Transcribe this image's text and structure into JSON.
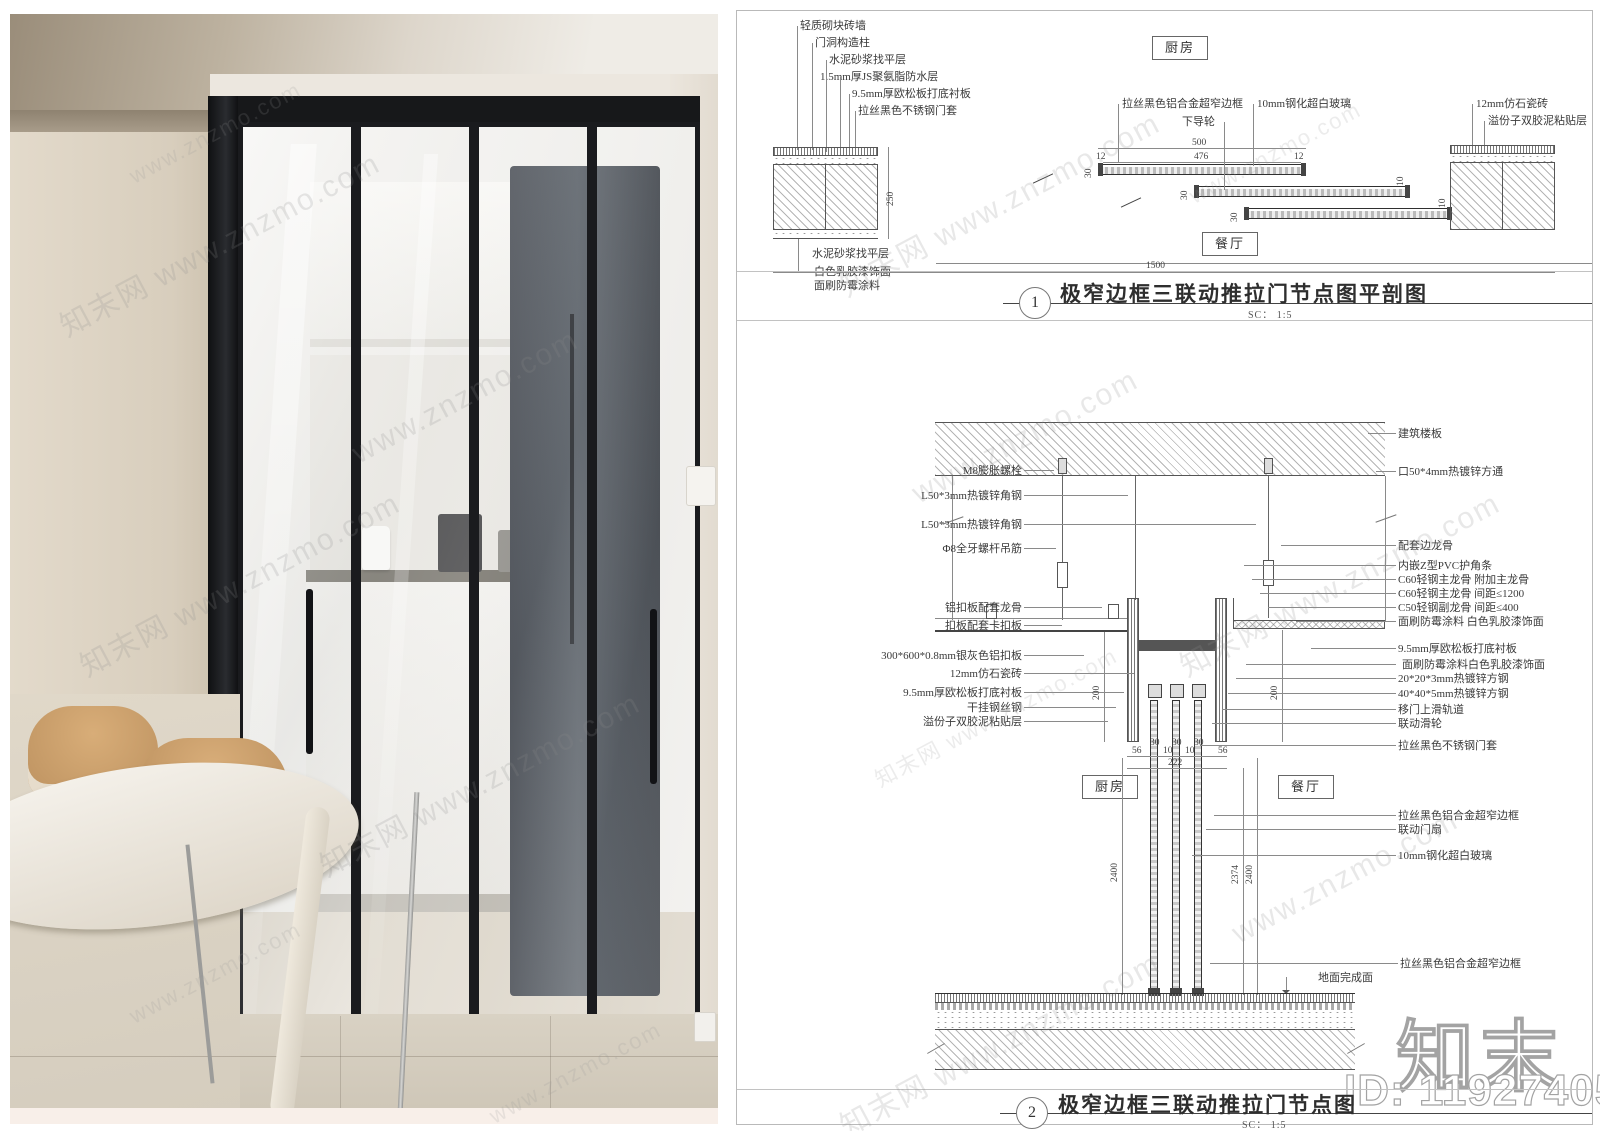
{
  "watermark": {
    "tile": "知末网 www.znzmo.com",
    "site": "www.znzmo.com"
  },
  "branding": {
    "logo": "知末",
    "id": "ID: 1192740511"
  },
  "drawing1": {
    "number": "1",
    "title": "极窄边框三联动推拉门节点图平剖图",
    "scale": "SC：  1:5",
    "room_top": "厨房",
    "room_bottom": "餐厅",
    "wall_labels_left": [
      "轻质砌块砖墙",
      "门洞构造柱",
      "水泥砂浆找平层",
      "1.5mm厚JS聚氨脂防水层",
      "9.5mm厚欧松板打底衬板",
      "拉丝黑色不锈钢门套"
    ],
    "door_labels": [
      "拉丝黑色铝合金超窄边框",
      "下导轮",
      "10mm钢化超白玻璃"
    ],
    "wall_labels_right": [
      "12mm仿石瓷砖",
      "溢份子双胶泥粘贴层"
    ],
    "bottom_labels": [
      "水泥砂浆找平层",
      "白色乳胶漆饰面",
      "面刷防霉涂料"
    ],
    "dims": {
      "overall": "1500",
      "opening": "500",
      "glass": "476",
      "edge_left": "12",
      "edge_right": "12",
      "panel": "30",
      "gap": "10",
      "wall_depth": "250"
    }
  },
  "drawing2": {
    "number": "2",
    "title": "极窄边框三联动推拉门节点图",
    "scale": "SC：  1:5",
    "room_left": "厨房",
    "room_right": "餐厅",
    "labels_left": [
      "M8膨胀螺栓",
      "L50*3mm热镀锌角钢",
      "L50*3mm热镀锌角钢",
      "Φ8全牙螺杆吊筋",
      "铝扣板配套龙骨",
      "扣板配套卡扣板",
      "300*600*0.8mm银灰色铝扣板",
      "12mm仿石瓷砖",
      "9.5mm厚欧松板打底衬板",
      "干挂钢丝钢",
      "溢份子双胶泥粘贴层"
    ],
    "labels_right": [
      "建筑楼板",
      "口50*4mm热镀锌方通",
      "配套边龙骨",
      "内嵌Z型PVC护角条",
      "C60轻钢主龙骨 附加主龙骨",
      "C60轻钢主龙骨 间距≤1200",
      "C50轻钢副龙骨 间距≤400",
      "面刷防霉涂料 白色乳胶漆饰面",
      "9.5mm厚欧松板打底衬板",
      "面刷防霉涂料白色乳胶漆饰面",
      "20*20*3mm热镀锌方钢",
      "40*40*5mm热镀锌方钢",
      "移门上滑轨道",
      "联动滑轮",
      "拉丝黑色不锈钢门套",
      "拉丝黑色铝合金超窄边框",
      "联动门扇",
      "10mm钢化超白玻璃",
      "拉丝黑色铝合金超窄边框",
      "地面完成面"
    ],
    "dims": {
      "drop_left": "200",
      "drop_right": "200",
      "height_left": "2400",
      "height_mid": "2374",
      "height_right": "2400",
      "jamb_left": "56",
      "p1": "30",
      "g1": "10",
      "p2": "30",
      "g2": "10",
      "p3": "30",
      "jamb_right": "56",
      "track_total": "222"
    }
  }
}
